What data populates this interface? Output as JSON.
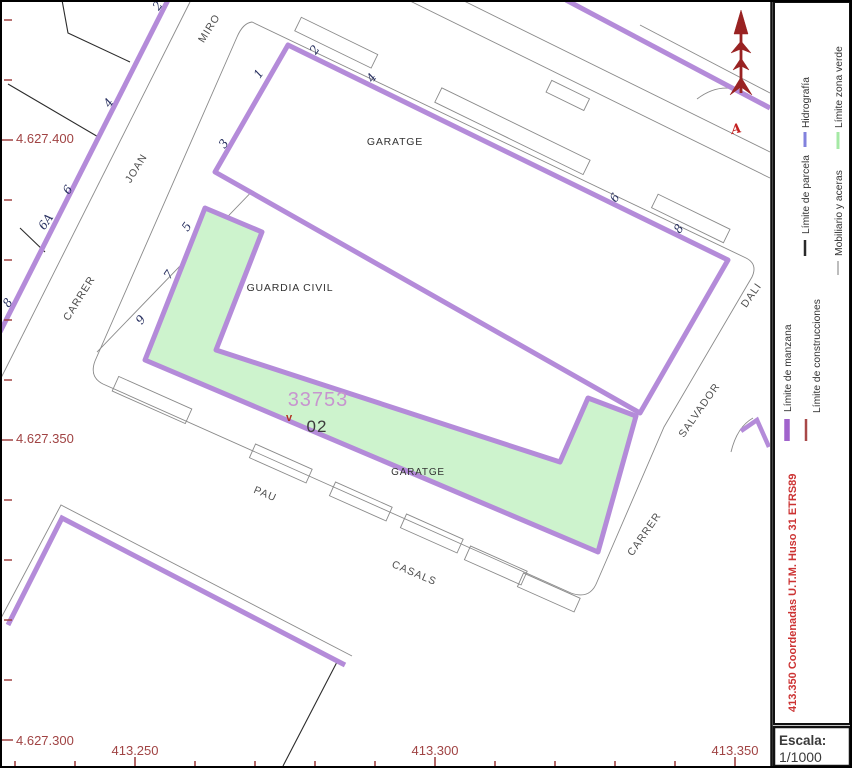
{
  "map": {
    "block_id": "33753",
    "sub_id": "02",
    "point_marker": "v",
    "north_letter": "A",
    "labels": {
      "garage_top": "GARATGE",
      "guardia": "GUARDIA CIVIL",
      "garage_bottom": "GARATGE"
    }
  },
  "streets": {
    "joan_miro": {
      "words": [
        "CARRER",
        "JOAN",
        "MIRO"
      ],
      "numbers": [
        "2",
        "4",
        "6",
        "6A",
        "8"
      ]
    },
    "pau_casals": {
      "words": [
        "PAU",
        "CASALS"
      ]
    },
    "salvador_dali": {
      "words": [
        "CARRER",
        "SALVADOR",
        "DALI"
      ]
    },
    "block_top_numbers": [
      "2",
      "4",
      "6",
      "8"
    ],
    "block_left_numbers": [
      "1",
      "3",
      "5",
      "7",
      "9"
    ]
  },
  "grid": {
    "y_labels": [
      "4.627.400",
      "4.627.350",
      "4.627.300"
    ],
    "x_labels": [
      "413.250",
      "413.300",
      "413.350"
    ]
  },
  "legend": {
    "items": [
      {
        "label": "Hidrografía",
        "color": "#8282dd"
      },
      {
        "label": "Límite zona verde",
        "color": "#a5e9a5"
      },
      {
        "label": "Límite de parcela",
        "color": "#2a2a2a"
      },
      {
        "label": "Mobiliario y aceras",
        "color": "#bdbdbd"
      },
      {
        "label": "Límite de manzana",
        "color": "#a163cc"
      },
      {
        "label": "Límite de construcciones",
        "color": "#a84848"
      }
    ],
    "note": "413.350 Coordenadas U.T.M. Huso 31 ETRS89"
  },
  "scale": {
    "label": "Escala:",
    "value": "1/1000"
  },
  "colors": {
    "green_zone": "#cdf3cd",
    "manzana": "#b48bd9",
    "coordinate": "#a04343"
  }
}
